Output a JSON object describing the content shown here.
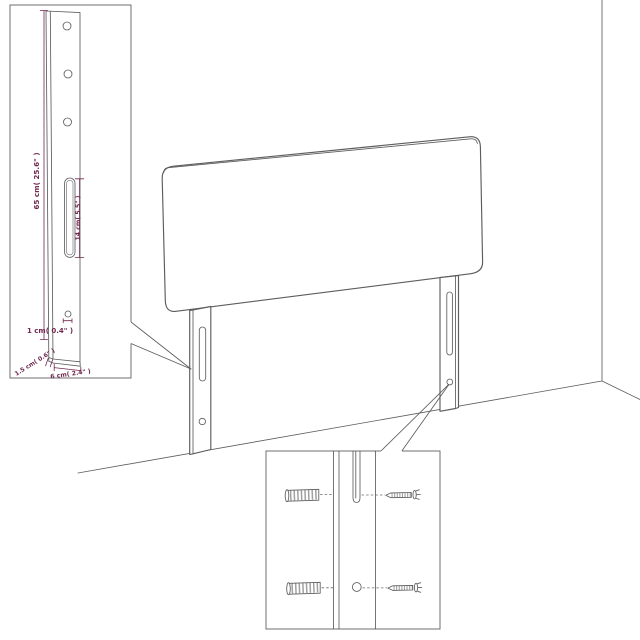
{
  "diagram": {
    "subject": "headboard-assembly-diagram",
    "labels": {
      "leg_height": "65 cm( 25.6\" )",
      "slot_length": "14 cm( 5.5\" )",
      "hole_diameter": "1 cm( 0.4\" )",
      "leg_depth": "1.5 cm( 0.6\" )",
      "leg_width": "6 cm( 2.4\" )"
    },
    "icons": [
      "wall-plug-icon",
      "screw-icon"
    ],
    "colors": {
      "outline": "#5d5d5d",
      "inset_border": "#6f6f6f",
      "dimension": "#71294f",
      "background": "#ffffff"
    }
  }
}
